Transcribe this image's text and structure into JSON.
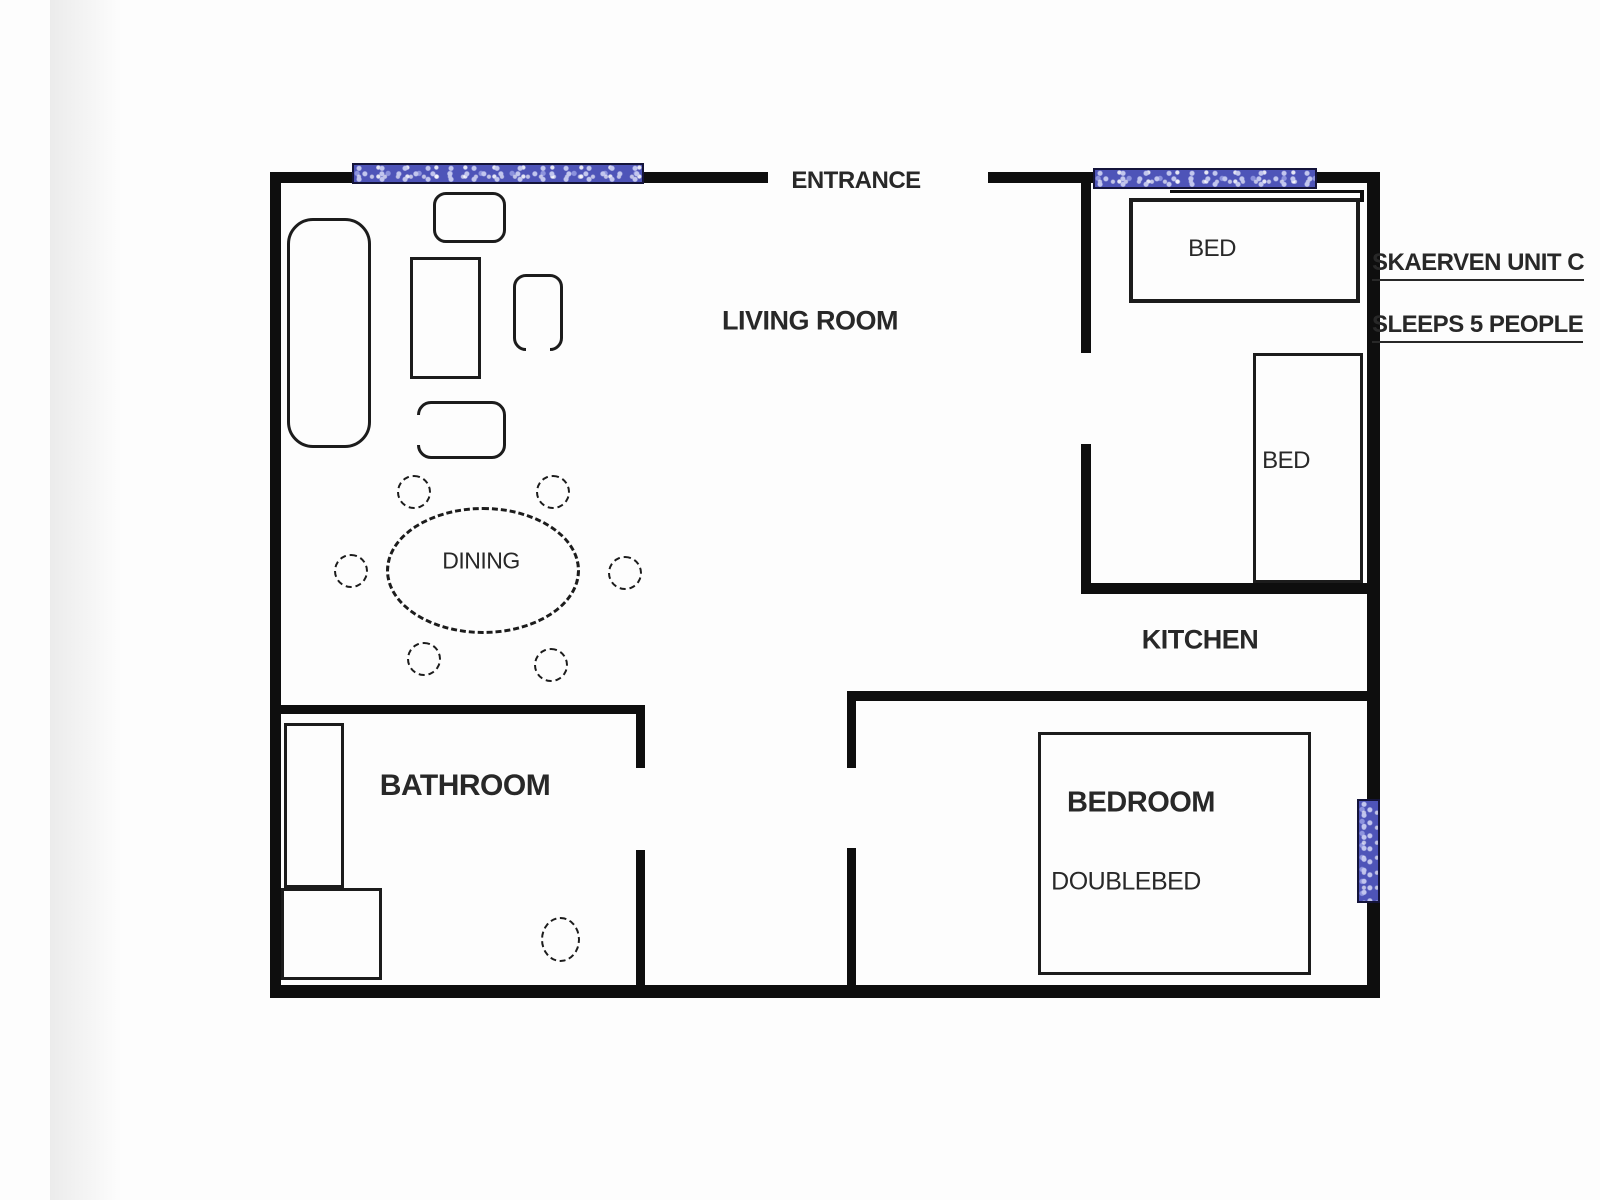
{
  "document": {
    "kind": "apartment floor plan",
    "unit_title": "SKAERVEN UNIT C",
    "capacity_note": "SLEEPS 5 PEOPLE"
  },
  "colors": {
    "background": "#fdfdfd",
    "wall": "#0e0e0e",
    "furniture_line": "#1c1c1c",
    "text": "#282828",
    "window_fill": "#4e54b8",
    "window_speckle": "#c2c6ee",
    "window_border": "#14143a"
  },
  "labels": [
    {
      "id": "entrance",
      "text": "ENTRANCE",
      "x": 856,
      "y": 181,
      "size": 24,
      "weight": 600
    },
    {
      "id": "living-room",
      "text": "LIVING ROOM",
      "x": 810,
      "y": 321,
      "size": 27,
      "weight": 700
    },
    {
      "id": "dining",
      "text": "DINING",
      "x": 481,
      "y": 561,
      "size": 23,
      "weight": 400
    },
    {
      "id": "kitchen",
      "text": "KITCHEN",
      "x": 1200,
      "y": 640,
      "size": 27,
      "weight": 700
    },
    {
      "id": "bathroom",
      "text": "BATHROOM",
      "x": 465,
      "y": 786,
      "size": 30,
      "weight": 700
    },
    {
      "id": "bedroom",
      "text": "BEDROOM",
      "x": 1141,
      "y": 803,
      "size": 29,
      "weight": 700
    },
    {
      "id": "doublebed",
      "text": "DOUBLEBED",
      "x": 1126,
      "y": 882,
      "size": 25,
      "weight": 400
    },
    {
      "id": "bed-top",
      "text": "BED",
      "x": 1212,
      "y": 249,
      "size": 24,
      "weight": 400
    },
    {
      "id": "bed-right",
      "text": "BED",
      "x": 1286,
      "y": 461,
      "size": 24,
      "weight": 400
    },
    {
      "id": "unit-title",
      "text": "SKAERVEN UNIT C",
      "x": 1372,
      "y": 266,
      "size": 24,
      "weight": 600,
      "underline": true,
      "align": "left"
    },
    {
      "id": "capacity",
      "text": "SLEEPS 5 PEOPLE",
      "x": 1372,
      "y": 328,
      "size": 24,
      "weight": 600,
      "underline": true,
      "align": "left"
    }
  ],
  "structure": {
    "walls": [
      {
        "name": "outer-top-wall-left",
        "x": 270,
        "y": 172,
        "w": 498,
        "h": 11
      },
      {
        "name": "outer-top-wall-right",
        "x": 988,
        "y": 172,
        "w": 392,
        "h": 11
      },
      {
        "name": "outer-left-wall",
        "x": 270,
        "y": 172,
        "w": 11,
        "h": 826
      },
      {
        "name": "outer-bottom-wall",
        "x": 270,
        "y": 985,
        "w": 1110,
        "h": 13
      },
      {
        "name": "outer-right-wall",
        "x": 1367,
        "y": 172,
        "w": 13,
        "h": 826
      },
      {
        "name": "twin-bedroom-left-wall-upper",
        "x": 1081,
        "y": 172,
        "w": 10,
        "h": 181
      },
      {
        "name": "twin-bedroom-left-wall-lower",
        "x": 1081,
        "y": 444,
        "w": 10,
        "h": 139
      },
      {
        "name": "twin-bedroom-bottom-wall",
        "x": 1081,
        "y": 583,
        "w": 299,
        "h": 11
      },
      {
        "name": "main-bedroom-top-wall",
        "x": 847,
        "y": 691,
        "w": 520,
        "h": 10
      },
      {
        "name": "main-bedroom-left-wall-upper",
        "x": 847,
        "y": 691,
        "w": 9,
        "h": 77
      },
      {
        "name": "main-bedroom-left-wall-lower",
        "x": 847,
        "y": 848,
        "w": 9,
        "h": 137
      },
      {
        "name": "bathroom-top-wall",
        "x": 270,
        "y": 705,
        "w": 375,
        "h": 9
      },
      {
        "name": "bathroom-right-wall-upper",
        "x": 636,
        "y": 705,
        "w": 9,
        "h": 63
      },
      {
        "name": "bathroom-right-wall-lower",
        "x": 636,
        "y": 850,
        "w": 9,
        "h": 135
      },
      {
        "name": "right-wall-stub",
        "x": 1368,
        "y": 734,
        "w": 12,
        "h": 40
      },
      {
        "name": "window-sill-line",
        "x": 1170,
        "y": 190,
        "w": 194,
        "h": 3
      },
      {
        "name": "window-sill-hook",
        "x": 1360,
        "y": 190,
        "w": 4,
        "h": 12
      }
    ],
    "windows": [
      {
        "name": "window-living-room",
        "x": 352,
        "y": 163,
        "w": 292,
        "h": 21
      },
      {
        "name": "window-twin-bedroom",
        "x": 1093,
        "y": 168,
        "w": 224,
        "h": 21
      },
      {
        "name": "window-main-bedroom",
        "x": 1357,
        "y": 799,
        "w": 23,
        "h": 104
      }
    ],
    "door_openings": [
      {
        "name": "entrance-opening",
        "x": 768,
        "y": 172,
        "w": 220,
        "h": 11
      },
      {
        "name": "twin-bedroom-doorway",
        "x": 1081,
        "y": 353,
        "w": 10,
        "h": 91
      },
      {
        "name": "bathroom-doorway",
        "x": 636,
        "y": 768,
        "w": 9,
        "h": 82
      },
      {
        "name": "main-bedroom-doorway",
        "x": 847,
        "y": 768,
        "w": 9,
        "h": 80
      }
    ]
  },
  "furniture": [
    {
      "name": "sofa",
      "type": "rounded",
      "x": 287,
      "y": 218,
      "w": 84,
      "h": 230,
      "r": 26,
      "stroke": 3
    },
    {
      "name": "armchair-top",
      "type": "rounded",
      "x": 433,
      "y": 192,
      "w": 73,
      "h": 51,
      "r": 13,
      "stroke": 3
    },
    {
      "name": "coffee-table",
      "type": "rect",
      "x": 410,
      "y": 257,
      "w": 71,
      "h": 122,
      "stroke": 3
    },
    {
      "name": "side-chair",
      "type": "rounded",
      "x": 513,
      "y": 274,
      "w": 50,
      "h": 77,
      "r": 13,
      "stroke": 3,
      "open": "bottom"
    },
    {
      "name": "armchair-bottom",
      "type": "rounded",
      "x": 417,
      "y": 401,
      "w": 89,
      "h": 58,
      "r": 14,
      "stroke": 3,
      "open": "left"
    },
    {
      "name": "dining-table",
      "type": "oval",
      "x": 386,
      "y": 507,
      "w": 194,
      "h": 127,
      "stroke": 3
    },
    {
      "name": "dining-chair-1",
      "type": "circle",
      "x": 397,
      "y": 475,
      "w": 34,
      "h": 34,
      "stroke": 2
    },
    {
      "name": "dining-chair-2",
      "type": "circle",
      "x": 536,
      "y": 475,
      "w": 34,
      "h": 34,
      "stroke": 2
    },
    {
      "name": "dining-chair-3",
      "type": "circle",
      "x": 334,
      "y": 554,
      "w": 34,
      "h": 34,
      "stroke": 2
    },
    {
      "name": "dining-chair-4",
      "type": "circle",
      "x": 608,
      "y": 556,
      "w": 34,
      "h": 34,
      "stroke": 2
    },
    {
      "name": "dining-chair-5",
      "type": "circle",
      "x": 407,
      "y": 642,
      "w": 34,
      "h": 34,
      "stroke": 2
    },
    {
      "name": "dining-chair-6",
      "type": "circle",
      "x": 534,
      "y": 648,
      "w": 34,
      "h": 34,
      "stroke": 2
    },
    {
      "name": "shower-unit",
      "type": "rect",
      "x": 284,
      "y": 723,
      "w": 60,
      "h": 165,
      "stroke": 3
    },
    {
      "name": "vanity-unit",
      "type": "rect",
      "x": 281,
      "y": 888,
      "w": 101,
      "h": 92,
      "stroke": 3
    },
    {
      "name": "toilet",
      "type": "circle",
      "x": 541,
      "y": 917,
      "w": 39,
      "h": 45,
      "stroke": 2
    },
    {
      "name": "double-bed",
      "type": "rect",
      "x": 1038,
      "y": 732,
      "w": 273,
      "h": 243,
      "stroke": 3
    },
    {
      "name": "single-bed-top",
      "type": "rect",
      "x": 1129,
      "y": 198,
      "w": 231,
      "h": 105,
      "stroke": 4
    },
    {
      "name": "single-bed-right",
      "type": "rect",
      "x": 1253,
      "y": 353,
      "w": 110,
      "h": 230,
      "stroke": 3
    }
  ]
}
